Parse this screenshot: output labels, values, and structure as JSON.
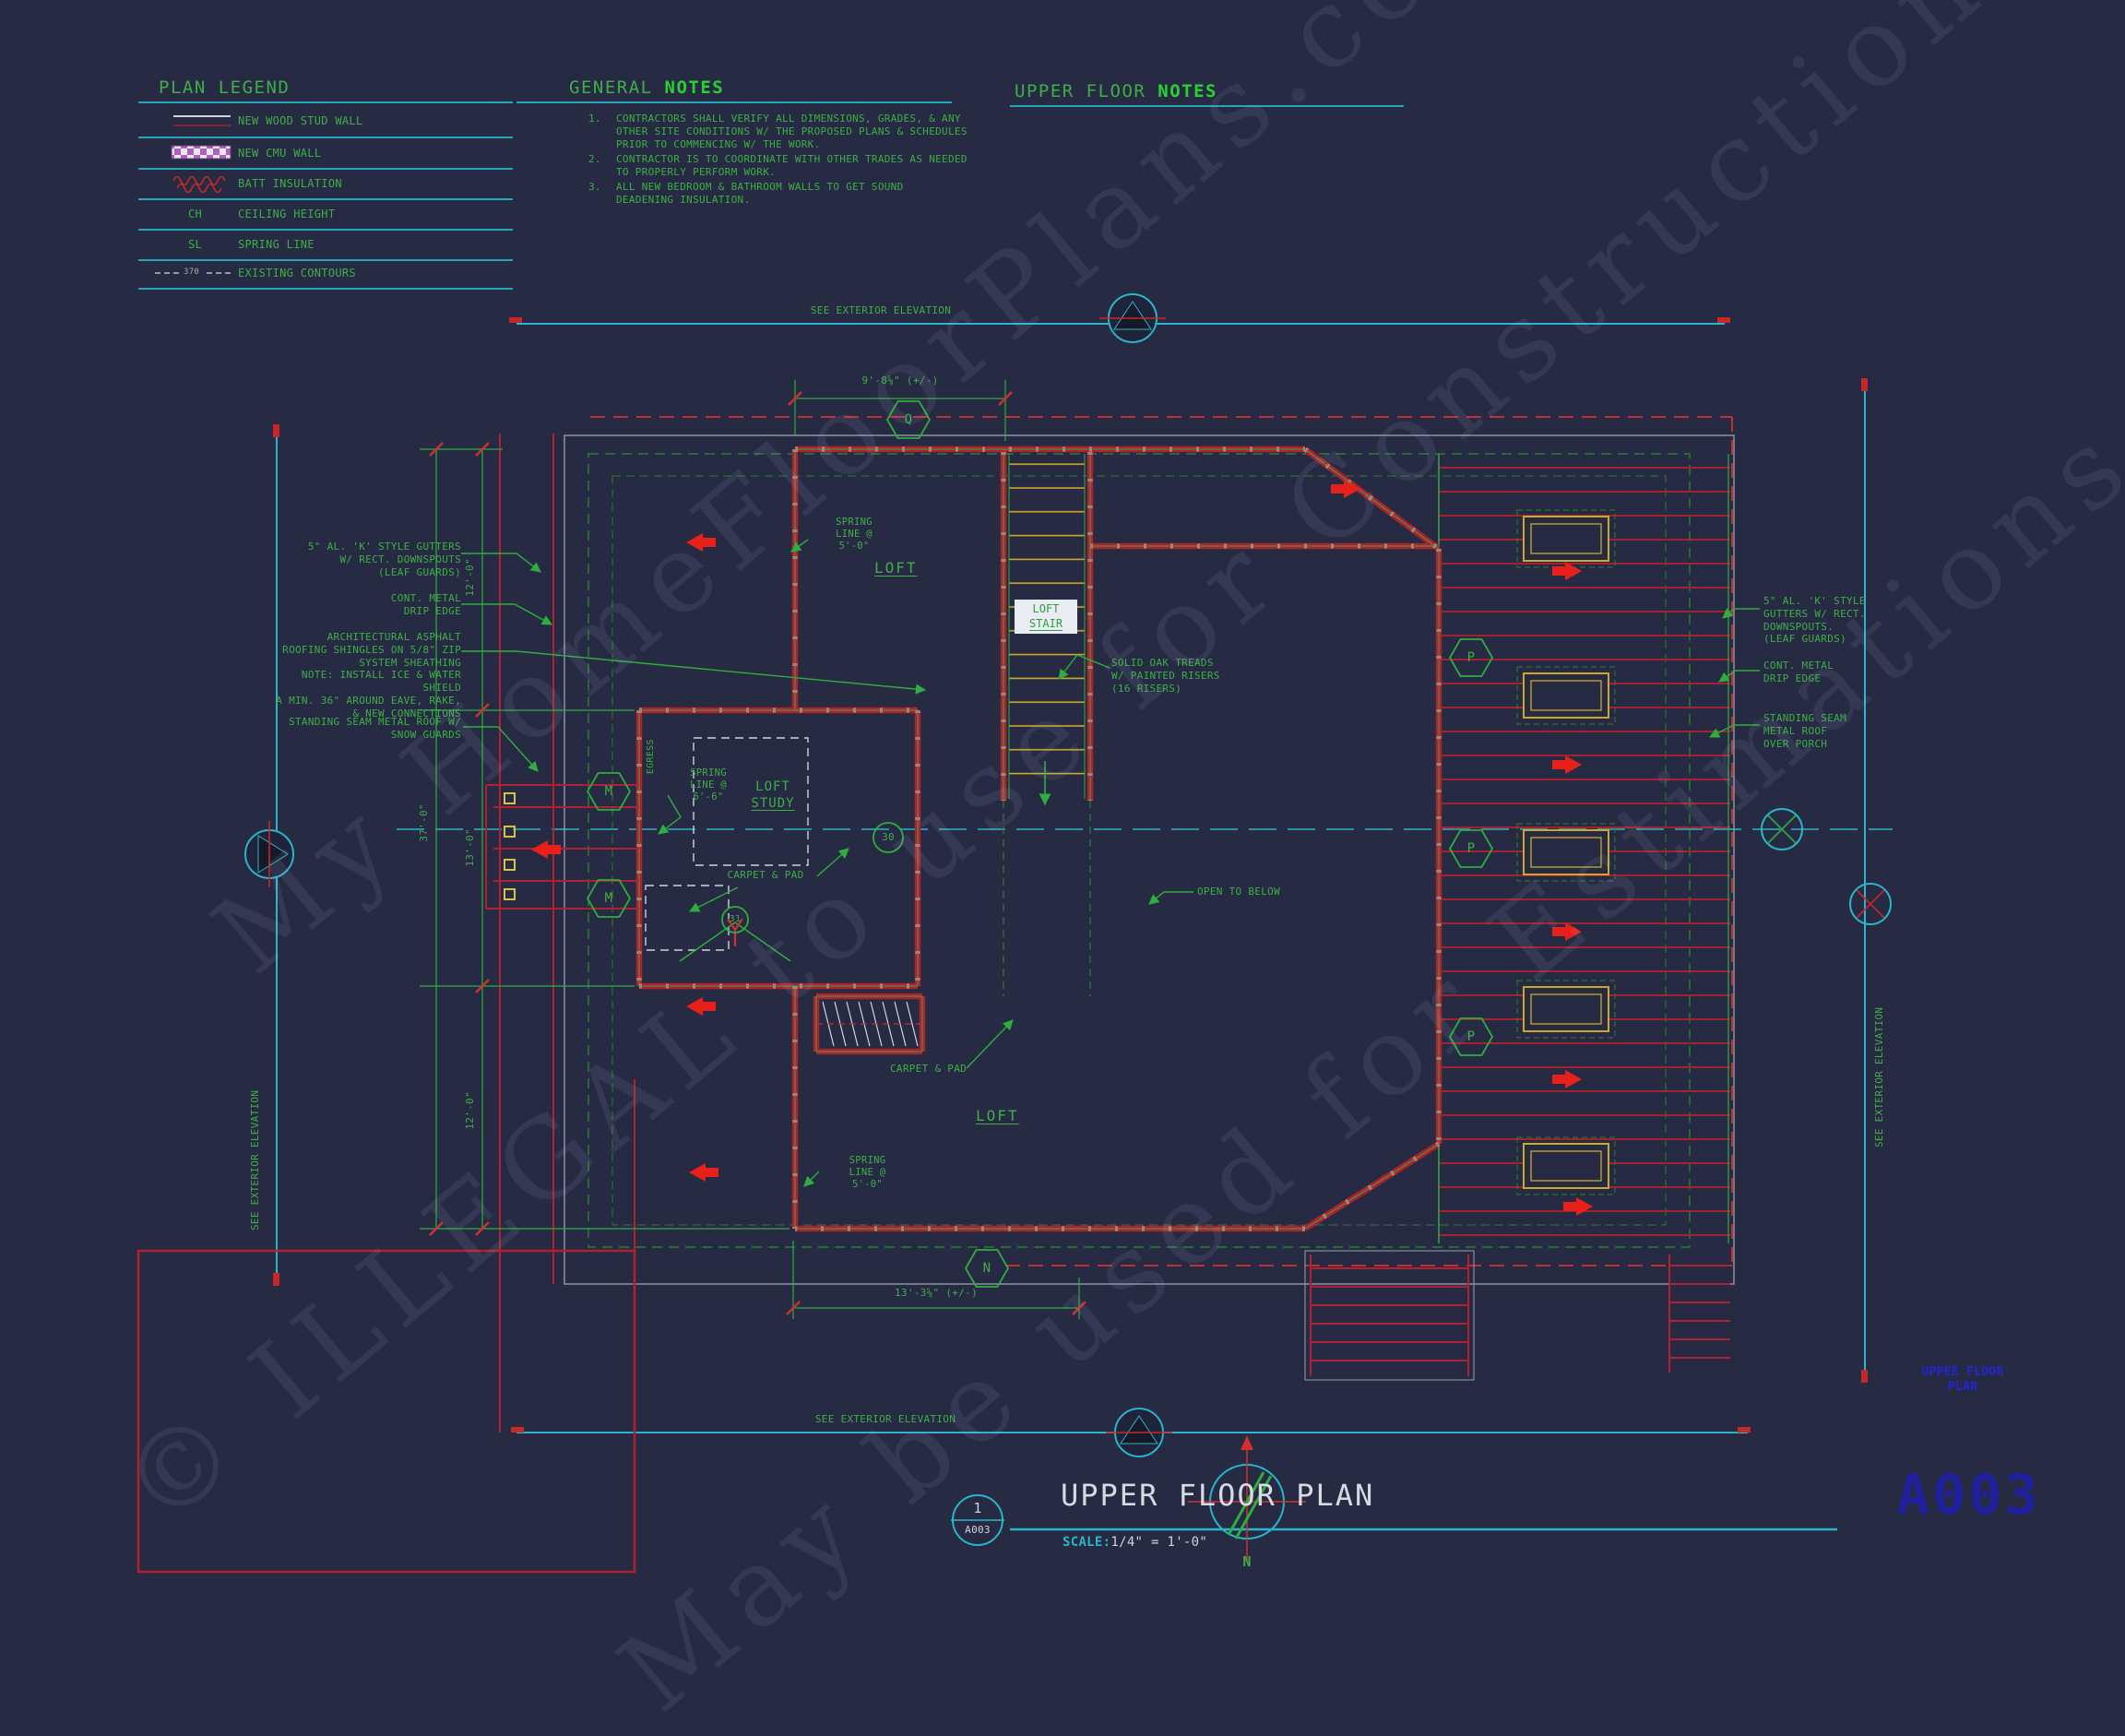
{
  "colors": {
    "background": "#262a43",
    "cad_green": "#3fae46",
    "bright_green": "#27d22e",
    "cyan": "#2ab5c8",
    "wall_red": "#b02030",
    "arrow_red": "#e8201a",
    "tread_yellow": "#caa92c",
    "cmu_magenta": "#b05fc0",
    "text_white": "#d7dae2",
    "sheet_blue": "#2424d8"
  },
  "legend": {
    "title": "PLAN LEGEND",
    "items": [
      {
        "label": "NEW WOOD STUD WALL"
      },
      {
        "label": "NEW CMU WALL"
      },
      {
        "label": "BATT INSULATION"
      },
      {
        "symbol": "CH",
        "label": "CEILING HEIGHT"
      },
      {
        "symbol": "SL",
        "label": "SPRING LINE"
      },
      {
        "symbol": "370",
        "label": "EXISTING CONTOURS"
      }
    ]
  },
  "general_notes": {
    "title_prefix": "GENERAL ",
    "title_suffix": "NOTES",
    "notes": [
      {
        "num": "1.",
        "text": "CONTRACTORS SHALL VERIFY ALL DIMENSIONS, GRADES, & ANY\nOTHER SITE CONDITIONS W/ THE PROPOSED PLANS & SCHEDULES\nPRIOR TO COMMENCING W/ THE WORK."
      },
      {
        "num": "2.",
        "text": "CONTRACTOR IS TO COORDINATE WITH OTHER TRADES AS NEEDED\nTO PROPERLY PERFORM WORK."
      },
      {
        "num": "3.",
        "text": "ALL NEW BEDROOM & BATHROOM WALLS TO GET SOUND\nDEADENING INSULATION."
      }
    ]
  },
  "upper_floor_notes": {
    "title_prefix": "UPPER FLOOR ",
    "title_suffix": "NOTES"
  },
  "elevation_note": "SEE EXTERIOR ELEVATION",
  "callouts": {
    "left_gutters": "5\" AL. 'K' STYLE GUTTERS\nW/ RECT. DOWNSPOUTS\n(LEAF GUARDS)",
    "left_drip": "CONT. METAL\nDRIP EDGE",
    "left_shingles": "ARCHITECTURAL ASPHALT\nROOFING SHINGLES ON 5/8\" ZIP\nSYSTEM SHEATHING\nNOTE: INSTALL ICE & WATER SHIELD\nA MIN. 36\" AROUND EAVE, RAKE,\n& NEW CONNECTIONS",
    "left_seam": "STANDING SEAM METAL ROOF W/\nSNOW GUARDS",
    "right_gutters": "5\" AL. 'K' STYLE\nGUTTERS W/ RECT.\nDOWNSPOUTS.\n(LEAF GUARDS)",
    "right_drip": "CONT. METAL\nDRIP EDGE",
    "right_seam": "STANDING SEAM\nMETAL ROOF\nOVER PORCH",
    "solid_oak": "SOLID OAK TREADS\nW/ PAINTED RISERS\n(16 RISERS)"
  },
  "labels": {
    "loft": "LOFT",
    "loft_stair_1": "LOFT",
    "loft_stair_2": "STAIR",
    "loft_study_1": "LOFT",
    "loft_study_2": "STUDY",
    "spring_line_5": "SPRING\nLINE @\n5'-0\"",
    "spring_line_6": "SPRING\nLINE @\n6'-6\"",
    "carpet_pad": "CARPET & PAD",
    "open_to_below": "OPEN TO BELOW",
    "egress": "EGRESS"
  },
  "dimensions": {
    "top": "9'-8⅝\" (+/-)",
    "bottom": "13'-3⅝\" (+/-)",
    "overall_left": "37'-0\"",
    "left_upper": "12'-0\"",
    "left_middle": "13'-0\"",
    "left_lower": "12'-0\""
  },
  "markers": {
    "q": "Q",
    "m": "M",
    "p": "P",
    "n": "N",
    "c30": "30",
    "c31": "31"
  },
  "title_block": {
    "detail_number": "1",
    "sheet_ref": "A003",
    "title": "UPPER FLOOR PLAN",
    "scale_label": "SCALE:",
    "scale_value": "1/4\" = 1'-0\"",
    "north": "N"
  },
  "sheet": {
    "side_title": "UPPER FLOOR\nPLAN",
    "number": "A003"
  },
  "watermark": {
    "line1": "My HomeFloorPlans.com",
    "line2": "© ILLEGAL to use for Construction",
    "line3": "May be used for Estimations"
  }
}
